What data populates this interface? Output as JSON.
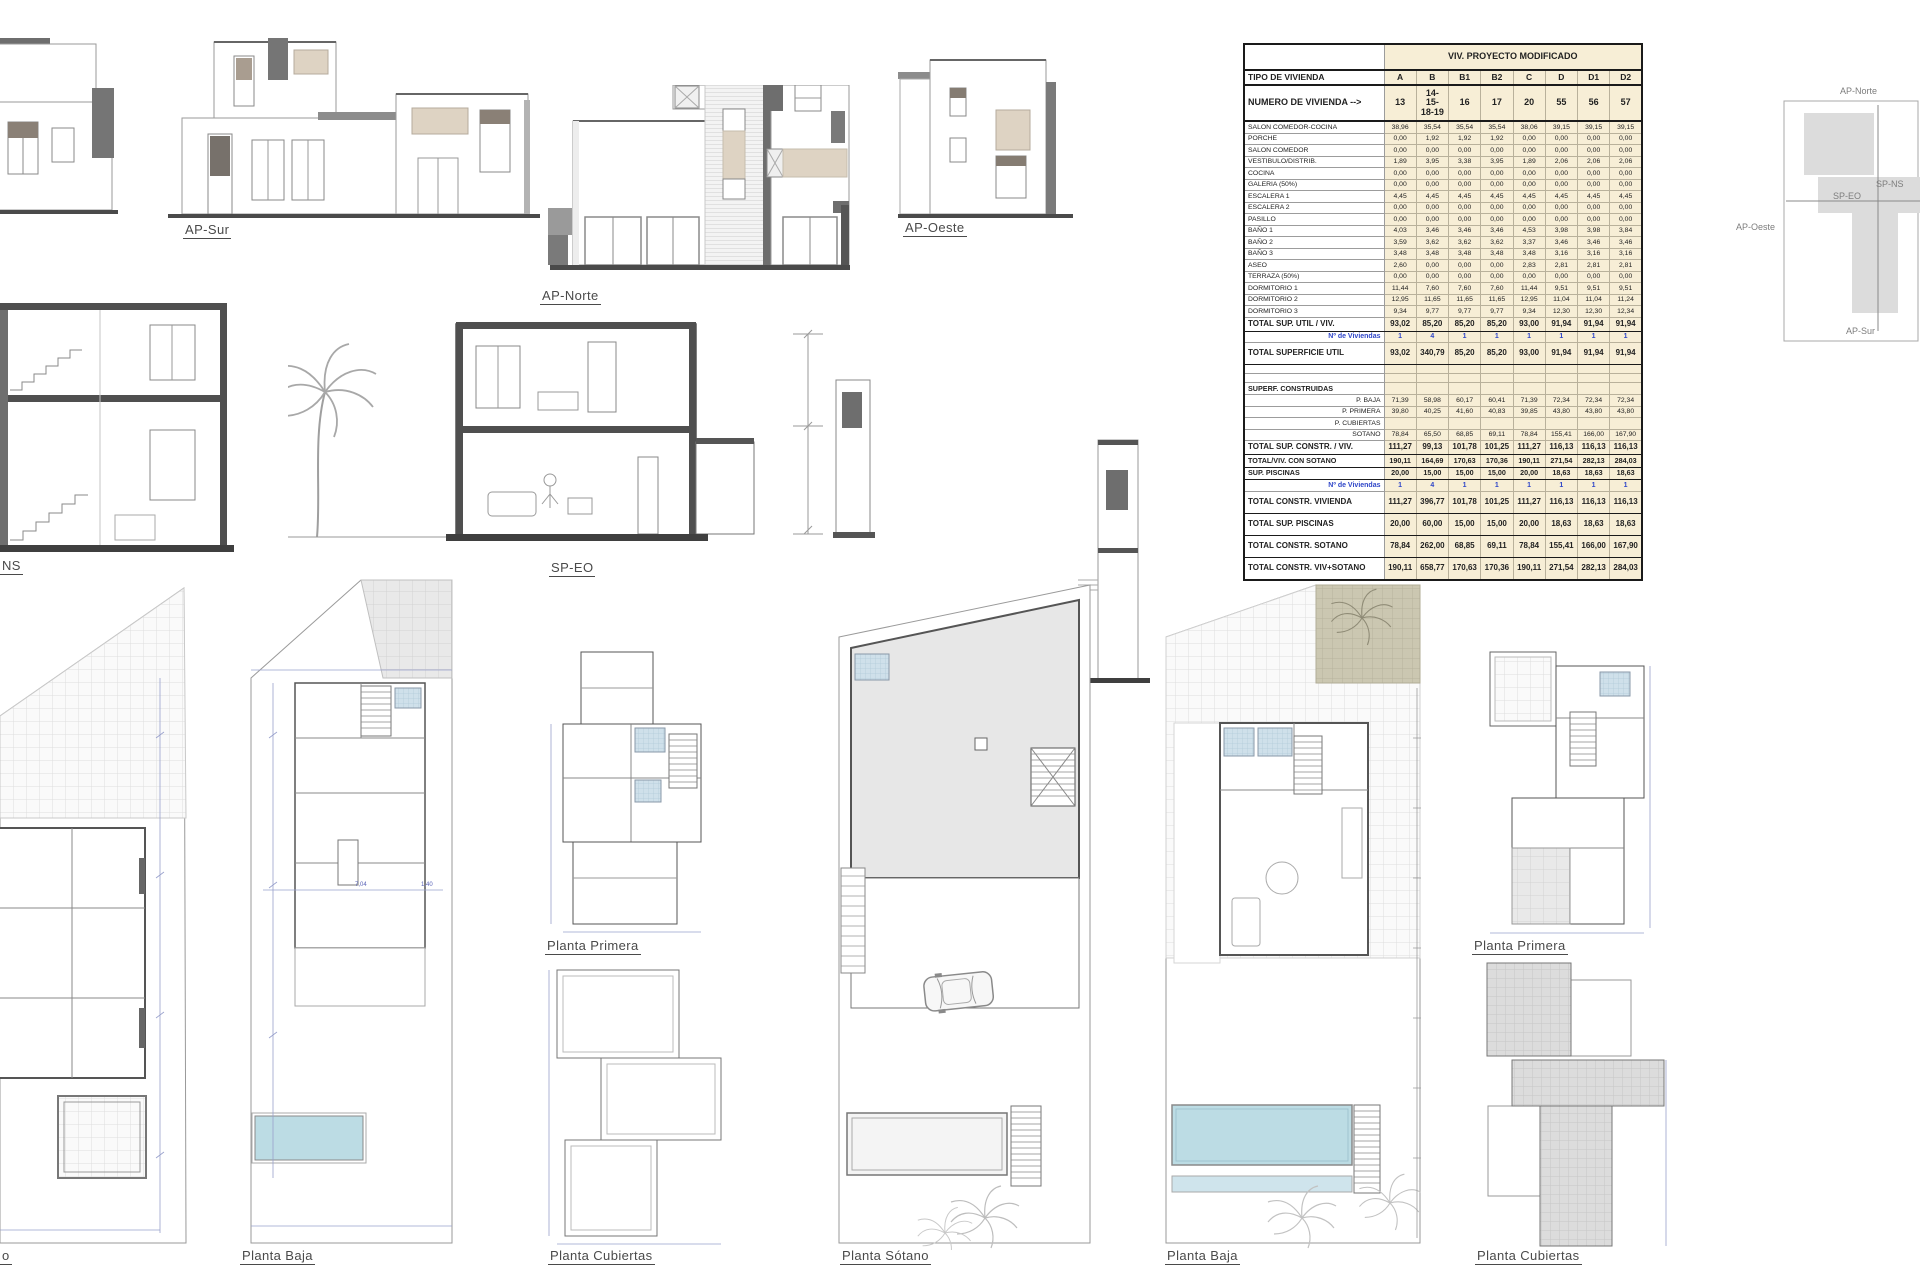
{
  "labels": {
    "ap_sur": "AP-Sur",
    "ap_norte": "AP-Norte",
    "ap_oeste": "AP-Oeste",
    "sp_ns_cut": "NS",
    "sp_eo": "SP-EO",
    "plan_left_cut": "o",
    "planta_baja_left": "Planta Baja",
    "planta_primera_left": "Planta Primera",
    "planta_cubiertas_left": "Planta Cubiertas",
    "planta_sotano": "Planta Sótano",
    "planta_baja_right": "Planta Baja",
    "planta_primera_right": "Planta Primera",
    "planta_cubiertas_right": "Planta Cubiertas"
  },
  "key_plan": {
    "north": "AP-Norte",
    "south": "AP-Sur",
    "west": "AP-Oeste",
    "section_ns": "SP-NS",
    "section_eo": "SP-EO"
  },
  "plans": {
    "planta_baja_left": {
      "dim_a": "7,04",
      "dim_b": "1,40"
    }
  },
  "colors": {
    "table_fill": "#f7eed6",
    "blue_text": "#2f46c8",
    "pool": "#bcdce4",
    "khaki": "#cbc7b1",
    "beige": "#ded3c3",
    "dim_blue": "#8e96c8"
  },
  "table": {
    "title": "VIV. PROYECTO MODIFICADO",
    "type_row": {
      "label": "TIPO DE VIVIENDA",
      "values": [
        "A",
        "B",
        "B1",
        "B2",
        "C",
        "D",
        "D1",
        "D2"
      ]
    },
    "number_row": {
      "label": "NUMERO DE VIVIENDA -->",
      "values": [
        "13",
        "14-15-18-19",
        "16",
        "17",
        "20",
        "55",
        "56",
        "57"
      ]
    },
    "rows": [
      {
        "label": "SALON COMEDOR-COCINA",
        "style": "small",
        "values": [
          "38,96",
          "35,54",
          "35,54",
          "35,54",
          "38,06",
          "39,15",
          "39,15",
          "39,15"
        ]
      },
      {
        "label": "PORCHE",
        "style": "small",
        "values": [
          "0,00",
          "1,92",
          "1,92",
          "1,92",
          "0,00",
          "0,00",
          "0,00",
          "0,00"
        ]
      },
      {
        "label": "SALON COMEDOR",
        "style": "small",
        "values": [
          "0,00",
          "0,00",
          "0,00",
          "0,00",
          "0,00",
          "0,00",
          "0,00",
          "0,00"
        ]
      },
      {
        "label": "VESTIBULO/DISTRIB.",
        "style": "small",
        "values": [
          "1,89",
          "3,95",
          "3,38",
          "3,95",
          "1,89",
          "2,06",
          "2,06",
          "2,06"
        ]
      },
      {
        "label": "COCINA",
        "style": "small",
        "values": [
          "0,00",
          "0,00",
          "0,00",
          "0,00",
          "0,00",
          "0,00",
          "0,00",
          "0,00"
        ]
      },
      {
        "label": "GALERIA (50%)",
        "style": "small",
        "values": [
          "0,00",
          "0,00",
          "0,00",
          "0,00",
          "0,00",
          "0,00",
          "0,00",
          "0,00"
        ]
      },
      {
        "label": "ESCALERA 1",
        "style": "small",
        "values": [
          "4,45",
          "4,45",
          "4,45",
          "4,45",
          "4,45",
          "4,45",
          "4,45",
          "4,45"
        ]
      },
      {
        "label": "ESCALERA 2",
        "style": "small",
        "values": [
          "0,00",
          "0,00",
          "0,00",
          "0,00",
          "0,00",
          "0,00",
          "0,00",
          "0,00"
        ]
      },
      {
        "label": "PASILLO",
        "style": "small",
        "values": [
          "0,00",
          "0,00",
          "0,00",
          "0,00",
          "0,00",
          "0,00",
          "0,00",
          "0,00"
        ]
      },
      {
        "label": "BAÑO 1",
        "style": "small",
        "values": [
          "4,03",
          "3,46",
          "3,46",
          "3,46",
          "4,53",
          "3,98",
          "3,98",
          "3,84"
        ]
      },
      {
        "label": "BAÑO 2",
        "style": "small",
        "values": [
          "3,59",
          "3,62",
          "3,62",
          "3,62",
          "3,37",
          "3,46",
          "3,46",
          "3,46"
        ]
      },
      {
        "label": "BAÑO 3",
        "style": "small",
        "values": [
          "3,48",
          "3,48",
          "3,48",
          "3,48",
          "3,48",
          "3,16",
          "3,16",
          "3,16"
        ]
      },
      {
        "label": "ASEO",
        "style": "small",
        "values": [
          "2,60",
          "0,00",
          "0,00",
          "0,00",
          "2,83",
          "2,81",
          "2,81",
          "2,81"
        ]
      },
      {
        "label": "TERRAZA (50%)",
        "style": "small",
        "values": [
          "0,00",
          "0,00",
          "0,00",
          "0,00",
          "0,00",
          "0,00",
          "0,00",
          "0,00"
        ]
      },
      {
        "label": "DORMITORIO 1",
        "style": "small",
        "values": [
          "11,44",
          "7,60",
          "7,60",
          "7,60",
          "11,44",
          "9,51",
          "9,51",
          "9,51"
        ]
      },
      {
        "label": "DORMITORIO 2",
        "style": "small",
        "values": [
          "12,95",
          "11,65",
          "11,65",
          "11,65",
          "12,95",
          "11,04",
          "11,04",
          "11,24"
        ]
      },
      {
        "label": "DORMITORIO 3",
        "style": "small",
        "values": [
          "9,34",
          "9,77",
          "9,77",
          "9,77",
          "9,34",
          "12,30",
          "12,30",
          "12,34"
        ]
      },
      {
        "label": "TOTAL SUP. UTIL / VIV.",
        "style": "bold",
        "values": [
          "93,02",
          "85,20",
          "85,20",
          "85,20",
          "93,00",
          "91,94",
          "91,94",
          "91,94"
        ]
      },
      {
        "label": "Nº de Viviendas",
        "style": "blue",
        "values": [
          "1",
          "4",
          "1",
          "1",
          "1",
          "1",
          "1",
          "1"
        ]
      },
      {
        "label": "TOTAL SUPERFICIE UTIL",
        "style": "tall",
        "values": [
          "93,02",
          "340,79",
          "85,20",
          "85,20",
          "93,00",
          "91,94",
          "91,94",
          "91,94"
        ]
      },
      {
        "label": "",
        "style": "empty",
        "values": [
          "",
          "",
          "",
          "",
          "",
          "",
          "",
          ""
        ]
      },
      {
        "label": "",
        "style": "empty",
        "values": [
          "",
          "",
          "",
          "",
          "",
          "",
          "",
          ""
        ]
      },
      {
        "label": "SUPERF. CONSTRUIDAS",
        "style": "section",
        "values": [
          "",
          "",
          "",
          "",
          "",
          "",
          "",
          ""
        ]
      },
      {
        "label": "P. BAJA",
        "style": "sub",
        "values": [
          "71,39",
          "58,98",
          "60,17",
          "60,41",
          "71,39",
          "72,34",
          "72,34",
          "72,34"
        ]
      },
      {
        "label": "P. PRIMERA",
        "style": "sub",
        "values": [
          "39,80",
          "40,25",
          "41,60",
          "40,83",
          "39,85",
          "43,80",
          "43,80",
          "43,80"
        ]
      },
      {
        "label": "P. CUBIERTAS",
        "style": "sub",
        "values": [
          "",
          "",
          "",
          "",
          "",
          "",
          "",
          ""
        ]
      },
      {
        "label": "SOTANO",
        "style": "sub",
        "values": [
          "78,84",
          "65,50",
          "68,85",
          "69,11",
          "78,84",
          "155,41",
          "166,00",
          "167,90"
        ]
      },
      {
        "label": "TOTAL SUP. CONSTR. / VIV.",
        "style": "bold",
        "values": [
          "111,27",
          "99,13",
          "101,78",
          "101,25",
          "111,27",
          "116,13",
          "116,13",
          "116,13"
        ]
      },
      {
        "label": "TOTAL/VIV. CON SOTANO",
        "style": "boldsm",
        "values": [
          "190,11",
          "164,69",
          "170,63",
          "170,36",
          "190,11",
          "271,54",
          "282,13",
          "284,03"
        ]
      },
      {
        "label": "SUP. PISCINAS",
        "style": "boldsm",
        "values": [
          "20,00",
          "15,00",
          "15,00",
          "15,00",
          "20,00",
          "18,63",
          "18,63",
          "18,63"
        ]
      },
      {
        "label": "Nº de Viviendas",
        "style": "blue",
        "values": [
          "1",
          "4",
          "1",
          "1",
          "1",
          "1",
          "1",
          "1"
        ]
      },
      {
        "label": "TOTAL CONSTR. VIVIENDA",
        "style": "tall",
        "values": [
          "111,27",
          "396,77",
          "101,78",
          "101,25",
          "111,27",
          "116,13",
          "116,13",
          "116,13"
        ]
      },
      {
        "label": "TOTAL SUP. PISCINAS",
        "style": "tall",
        "values": [
          "20,00",
          "60,00",
          "15,00",
          "15,00",
          "20,00",
          "18,63",
          "18,63",
          "18,63"
        ]
      },
      {
        "label": "TOTAL CONSTR. SOTANO",
        "style": "tall",
        "values": [
          "78,84",
          "262,00",
          "68,85",
          "69,11",
          "78,84",
          "155,41",
          "166,00",
          "167,90"
        ]
      },
      {
        "label": "TOTAL CONSTR. VIV+SOTANO",
        "style": "tall",
        "values": [
          "190,11",
          "658,77",
          "170,63",
          "170,36",
          "190,11",
          "271,54",
          "282,13",
          "284,03"
        ]
      }
    ]
  }
}
